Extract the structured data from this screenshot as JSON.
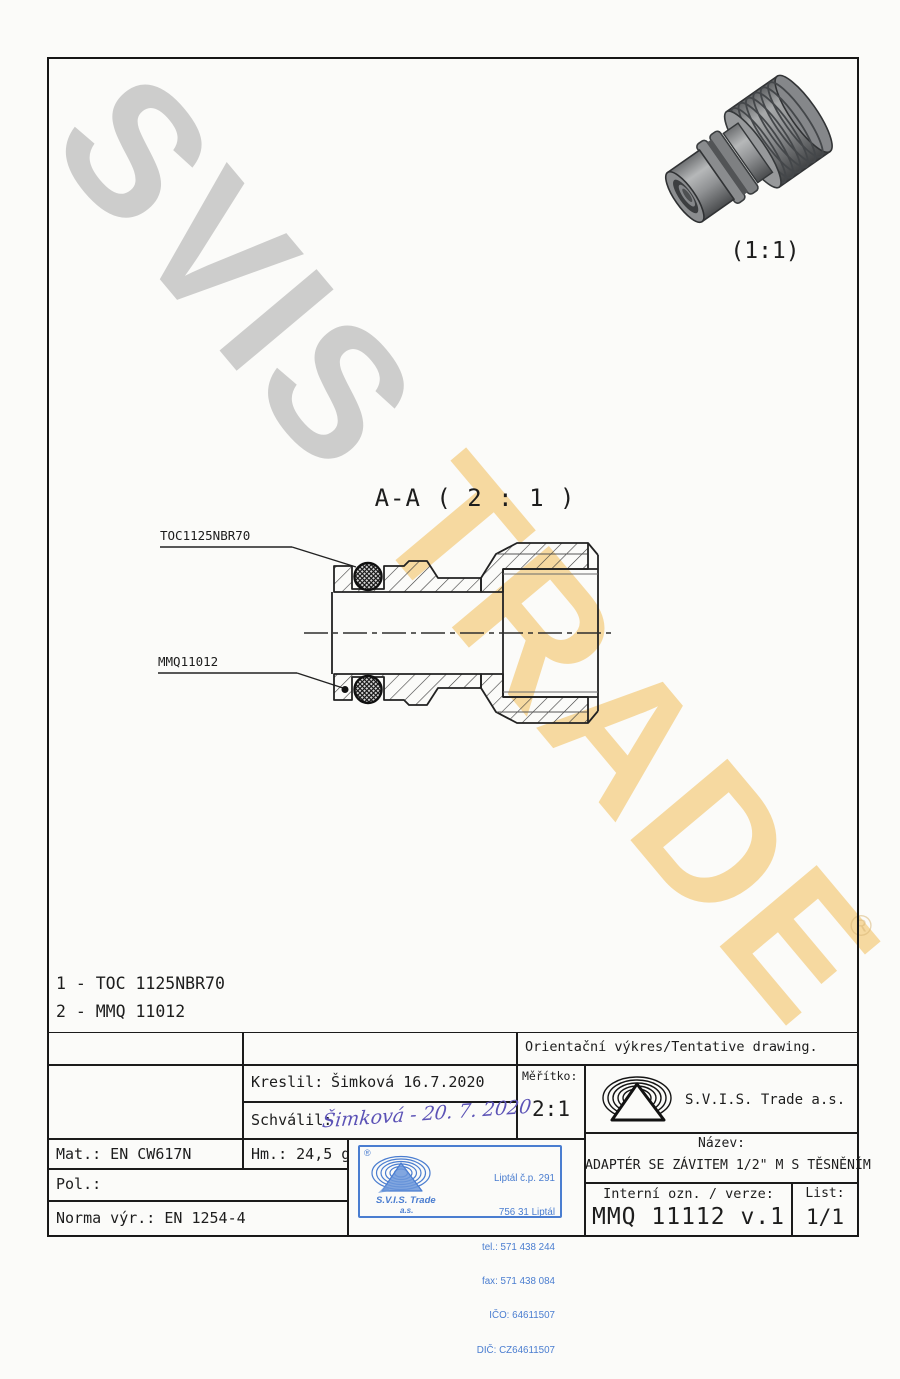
{
  "page": {
    "background_color": "#fbfbf9",
    "ink_color": "#1d1d1d",
    "stamp_blue": "#4a7dd0",
    "signature_blue": "#5c53b6",
    "watermark_gray": "#a8a8a8",
    "watermark_yellow": "#f2b848"
  },
  "watermark": {
    "gray_text": "SVIS",
    "yellow_text": "TRADE",
    "registered": "®"
  },
  "preview": {
    "scale_label": "(1:1)"
  },
  "section": {
    "title": "A-A ( 2 : 1 )",
    "label_oring": "TOC1125NBR70",
    "label_body": "MMQ11012"
  },
  "parts_list": {
    "items": [
      "1 - TOC 1125NBR70",
      "2 - MMQ 11012"
    ]
  },
  "title_block": {
    "tentative_note": "Orientační výkres/Tentative drawing.",
    "kreslil_label": "Kreslil:",
    "kreslil_value": "Šimková 16.7.2020",
    "schvalil_label": "Schválil:",
    "schvalil_signature": "Šimková - 20. 7. 2020",
    "meritko_label": "Měřítko:",
    "meritko_value": "2:1",
    "company_name": "S.V.I.S. Trade a.s.",
    "mat_value": "Mat.: EN CW617N",
    "hm_value": "Hm.: 24,5 g",
    "pol_value": "Pol.:",
    "norma_value": "Norma výr.: EN 1254-4",
    "nazev_label": "Název:",
    "nazev_value": "ADAPTÉR SE ZÁVITEM 1/2\" M S TĚSNĚNÍM",
    "interni_label": "Interní ozn. / verze:",
    "interni_value": "MMQ 11112 v.1",
    "list_label": "List:",
    "list_value": "1/1"
  },
  "stamp": {
    "registered": "®",
    "company_line1": "S.V.I.S. Trade",
    "company_line2": "a.s.",
    "address_lines": [
      "Liptál č.p. 291",
      "756 31 Liptál",
      "tel.: 571 438 244",
      "fax: 571 438 084",
      "IČO: 64611507",
      "DIČ: CZ64611507"
    ]
  }
}
